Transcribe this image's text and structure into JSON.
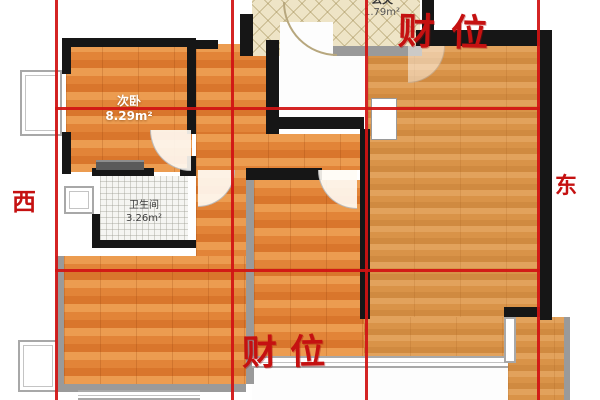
{
  "wealth": {
    "top": "财位",
    "bottom": "财位",
    "color": "#c51111"
  },
  "compass": {
    "west": "西",
    "east": "东"
  },
  "rooms": {
    "second_bedroom": {
      "name": "次卧",
      "area": "8.29m²"
    },
    "bathroom": {
      "name": "卫生间",
      "area": "3.26m²"
    },
    "entry": {
      "name": "玄关",
      "area": "1.79m²"
    }
  },
  "palette": {
    "grid_red": "#d11313",
    "wall_black": "#161616",
    "wall_gray": "#9a9a9a",
    "wood_floor": "#e2873a",
    "wood_floor_light": "#d89448",
    "entry_tile": "#eee4c6",
    "bath_tile": "#f5f5f2"
  }
}
